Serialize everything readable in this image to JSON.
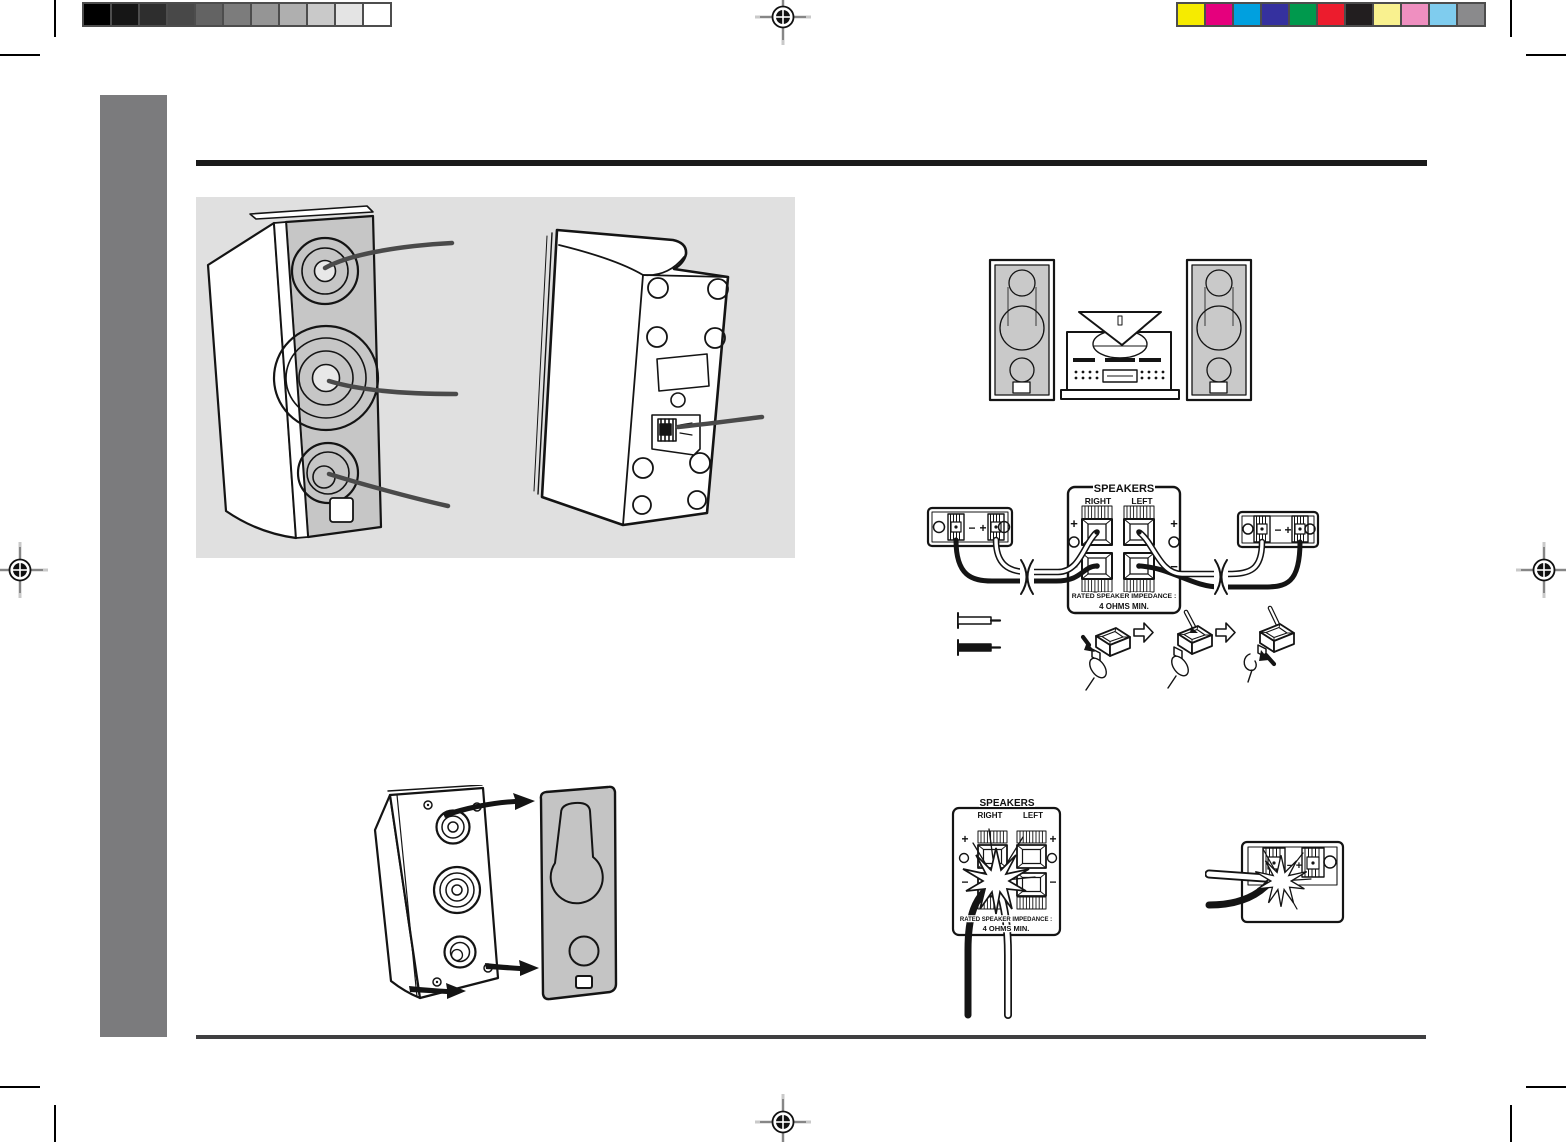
{
  "page": {
    "type": "printed-manual-page",
    "background": "#ffffff",
    "sidebar_color": "#7b7b7d",
    "illustration_panel_background": "#e0e0e0"
  },
  "print_calibration": {
    "grayscale_bar": [
      "#000000",
      "#161616",
      "#2e2e2e",
      "#484848",
      "#636363",
      "#7c7c7c",
      "#959595",
      "#afafaf",
      "#c9c9c9",
      "#e4e4e4",
      "#ffffff"
    ],
    "color_bar": [
      "#f6eb00",
      "#e5007d",
      "#00a0df",
      "#35319f",
      "#00994d",
      "#ec1c2d",
      "#221e1f",
      "#f9f18f",
      "#ef8fc0",
      "#7fccee",
      "#8a8a8c"
    ]
  },
  "amp_terminal_panel": {
    "title": "SPEAKERS",
    "col_right": "RIGHT",
    "col_left": "LEFT",
    "plus": "+",
    "minus": "−",
    "rated_line1": "RATED SPEAKER IMPEDANCE :",
    "rated_line2": "4 OHMS MIN."
  },
  "speaker_terminal_block": {
    "minus": "−",
    "plus": "+"
  }
}
